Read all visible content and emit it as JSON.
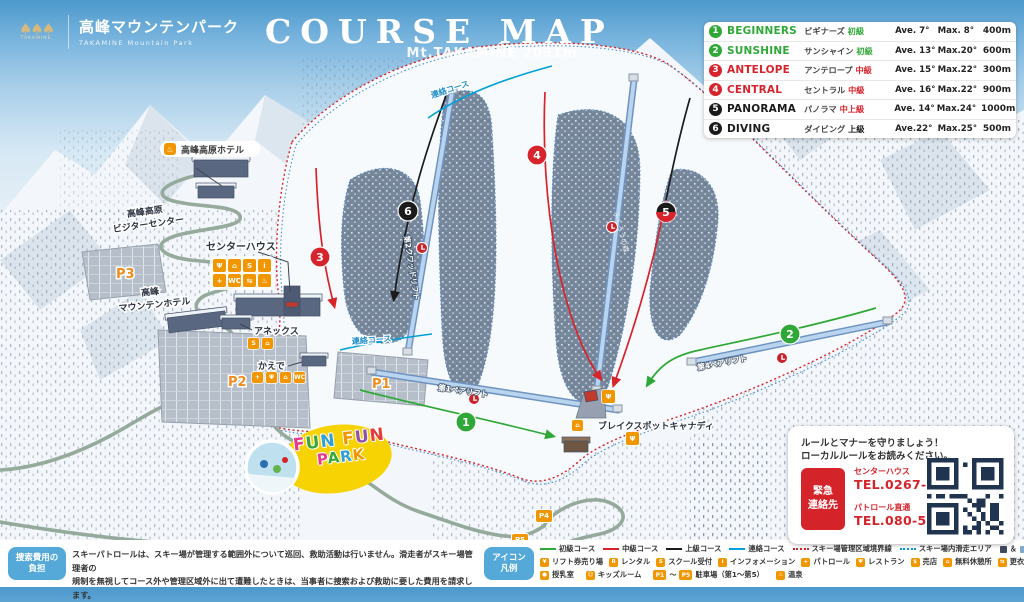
{
  "header": {
    "logo_mark": "TAKAMINE",
    "logo_jp": "高峰マウンテンパーク",
    "logo_en": "TAKAMINE Mountain Park",
    "title": "COURSE MAP"
  },
  "course_table": {
    "rows": [
      {
        "num": "1",
        "name": "BEGINNERS",
        "jp": "ビギナーズ",
        "level": "初級",
        "ave": "Ave. 7°",
        "max": "Max. 8°",
        "dist": "400m",
        "badge": "#2fa838",
        "color": "#2fa838",
        "level_color": "#2fa838"
      },
      {
        "num": "2",
        "name": "SUNSHINE",
        "jp": "サンシャイン",
        "level": "初級",
        "ave": "Ave. 13°",
        "max": "Max.20°",
        "dist": "600m",
        "badge": "#2fa838",
        "color": "#2fa838",
        "level_color": "#2fa838"
      },
      {
        "num": "3",
        "name": "ANTELOPE",
        "jp": "アンテロープ",
        "level": "中級",
        "ave": "Ave. 15°",
        "max": "Max.22°",
        "dist": "300m",
        "badge": "#d7242c",
        "color": "#d7242c",
        "level_color": "#d7242c"
      },
      {
        "num": "4",
        "name": "CENTRAL",
        "jp": "セントラル",
        "level": "中級",
        "ave": "Ave. 16°",
        "max": "Max.22°",
        "dist": "900m",
        "badge": "#d7242c",
        "color": "#d7242c",
        "level_color": "#d7242c"
      },
      {
        "num": "5",
        "name": "PANORAMA",
        "jp": "パノラマ",
        "level": "中上級",
        "ave": "Ave. 14°",
        "max": "Max.24°",
        "dist": "1000m",
        "badge": "#1b1b1b",
        "color": "#1b1b1b",
        "level_color": "#d7242c"
      },
      {
        "num": "6",
        "name": "DIVING",
        "jp": "ダイビング",
        "level": "上級",
        "ave": "Ave.22°",
        "max": "Max.25°",
        "dist": "500m",
        "badge": "#1b1b1b",
        "color": "#1b1b1b",
        "level_color": "#1b1b1b"
      }
    ]
  },
  "map": {
    "peak": "Mt.TAKAMINE 2091m",
    "connector_label": "連絡コース",
    "lifts": {
      "lift1": "第1ペアリフト",
      "lift2": "第2クワッドリフト",
      "lift4": "第4ペアリフト"
    },
    "forest": "ふくろうの森",
    "facilities": {
      "hotel": "高峰高原ホテル",
      "visitor1": "高峰高原",
      "visitor2": "ビジターセンター",
      "center_house": "センターハウス",
      "mt_hotel1": "高峰",
      "mt_hotel2": "マウンテンホテル",
      "annex": "アネックス",
      "kaede": "かえで",
      "break_spot": "ブレイクスポットキャナディ",
      "fun1": "FUN FUN",
      "fun2": "PARK"
    },
    "parking": {
      "p1": "P1",
      "p2": "P2",
      "p3": "P3",
      "p4": "P4",
      "p5": "P5"
    },
    "icon_clusters": {
      "center": [
        "Ψ",
        "⌂",
        "S",
        "i",
        "+",
        "WC",
        "⇆",
        "♨"
      ],
      "annex": [
        "S",
        "⌂"
      ],
      "kaede": [
        "+",
        "Ψ",
        "⌂",
        "WC"
      ],
      "break1": [
        "Ψ"
      ],
      "break2": [
        "Ψ"
      ],
      "break3": [
        "⌂"
      ]
    }
  },
  "notice": {
    "badge1": "捜索費用の",
    "badge2": "負担",
    "line1": "スキーパトロールは、スキー場が管理する範囲外について巡回、救助活動は行いません。滑走者がスキー場管理者の",
    "line2": "規制を無視してコース外や管理区域外に出て遭難したときは、当事者に捜索および救助に要した費用を請求します。"
  },
  "legend": {
    "badge1": "アイコン",
    "badge2": "凡例",
    "lines": [
      {
        "label": "初級コース",
        "color": "#2fa838",
        "dotted": false
      },
      {
        "label": "中級コース",
        "color": "#d7242c",
        "dotted": false
      },
      {
        "label": "上級コース",
        "color": "#1b1b1b",
        "dotted": false
      },
      {
        "label": "連絡コース",
        "color": "#00a0d8",
        "dotted": false
      },
      {
        "label": "スキー場管理区域境界線",
        "color": "#d7242c",
        "dotted": true
      },
      {
        "label": "スキー場内滑走エリア",
        "color": "#00a0d8",
        "dotted": true
      }
    ],
    "no_entry": {
      "sq1": "#3e4a5c",
      "sq2": "#7ea8cc",
      "amp": "＆",
      "label": "立入禁止（コース外）"
    },
    "icons_row2": [
      {
        "glyph": "¥",
        "label": "リフト券売り場"
      },
      {
        "glyph": "R",
        "label": "レンタル"
      },
      {
        "glyph": "S",
        "label": "スクール受付"
      },
      {
        "glyph": "i",
        "label": "インフォメーション"
      },
      {
        "glyph": "+",
        "label": "パトロール"
      },
      {
        "glyph": "Ψ",
        "label": "レストラン"
      },
      {
        "glyph": "$",
        "label": "売店"
      },
      {
        "glyph": "⌂",
        "label": "無料休憩所"
      },
      {
        "glyph": "⇆",
        "label": "更衣室"
      },
      {
        "glyph": "WC",
        "label": "トイレ"
      }
    ],
    "icons_row3": [
      {
        "glyph": "●",
        "label": "授乳室"
      },
      {
        "glyph": "☺",
        "label": "キッズルーム"
      },
      {
        "parking": true,
        "label": "駐車場（第1～第5）"
      },
      {
        "glyph": "♨",
        "label": "温泉"
      }
    ]
  },
  "emergency": {
    "line1": "ルールとマナーを守りましょう！",
    "line2": "ローカルルールをお読みください。",
    "badge1": "緊急",
    "badge2": "連絡先",
    "contact1_name": "センターハウス",
    "contact1_tel": "TEL.0267-23-1714",
    "contact2_name": "パトロール直通",
    "contact2_tel": "TEL.080-5894-6398"
  }
}
